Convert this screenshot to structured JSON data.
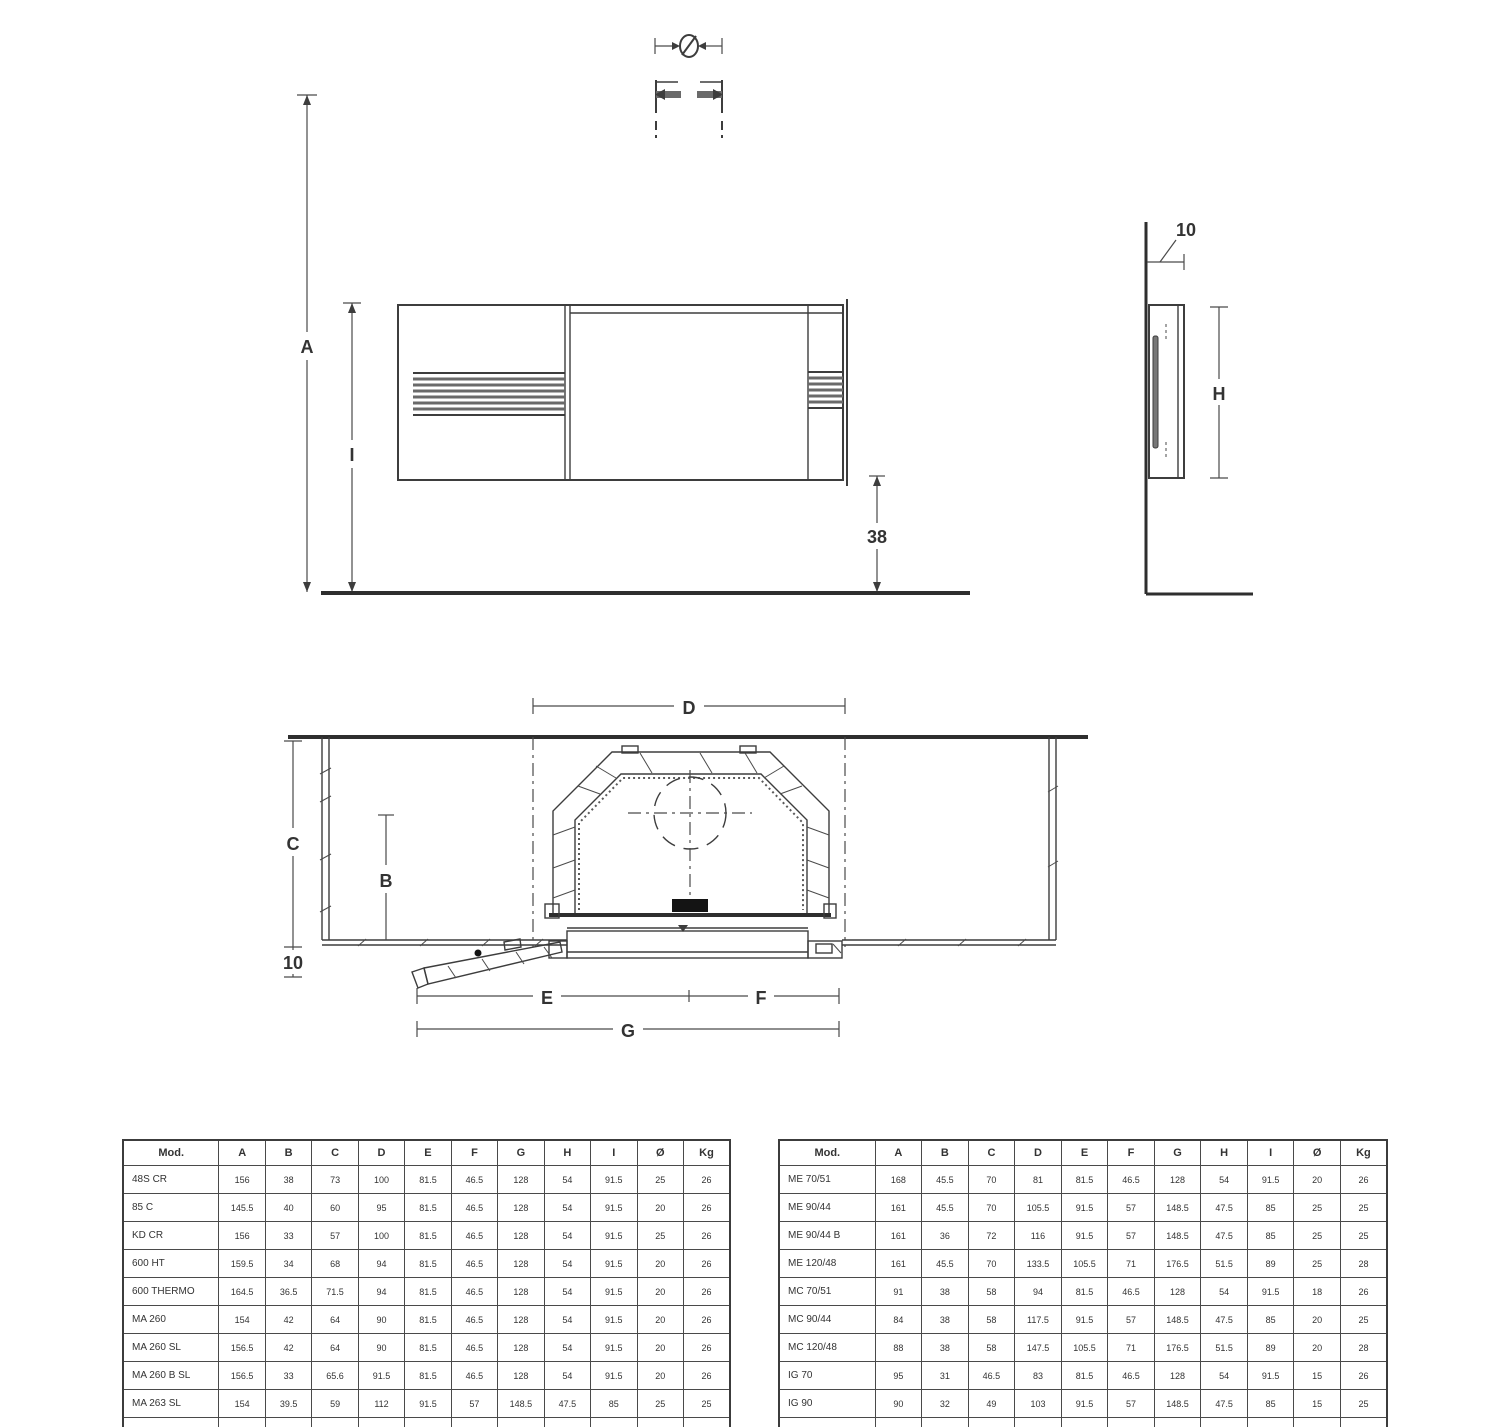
{
  "drawing": {
    "labels": {
      "flue_diameter": "Ø",
      "total_height": "A",
      "hood_top_height": "I",
      "bottom_clearance": "38",
      "wall_depth": "10",
      "glass_height": "H",
      "firebox_width": "D",
      "side_depth": "C",
      "firebox_depth": "B",
      "front_offset": "10",
      "left_width": "E",
      "right_width": "F",
      "total_width": "G"
    },
    "colors": {
      "line": "#3d3d3d",
      "grille_stripe": "#6a6a6a",
      "glass_fill": "#777777",
      "black_fill": "#141414",
      "table_border": "#4a4a4a",
      "text": "#333333"
    }
  },
  "tables": {
    "headers": [
      "Mod.",
      "A",
      "B",
      "C",
      "D",
      "E",
      "F",
      "G",
      "H",
      "I",
      "Ø",
      "Kg"
    ],
    "left": {
      "rows": [
        [
          "48S CR",
          "156",
          "38",
          "73",
          "100",
          "81.5",
          "46.5",
          "128",
          "54",
          "91.5",
          "25",
          "26"
        ],
        [
          "85 C",
          "145.5",
          "40",
          "60",
          "95",
          "81.5",
          "46.5",
          "128",
          "54",
          "91.5",
          "20",
          "26"
        ],
        [
          "KD CR",
          "156",
          "33",
          "57",
          "100",
          "81.5",
          "46.5",
          "128",
          "54",
          "91.5",
          "25",
          "26"
        ],
        [
          "600 HT",
          "159.5",
          "34",
          "68",
          "94",
          "81.5",
          "46.5",
          "128",
          "54",
          "91.5",
          "20",
          "26"
        ],
        [
          "600 THERMO",
          "164.5",
          "36.5",
          "71.5",
          "94",
          "81.5",
          "46.5",
          "128",
          "54",
          "91.5",
          "20",
          "26"
        ],
        [
          "MA 260",
          "154",
          "42",
          "64",
          "90",
          "81.5",
          "46.5",
          "128",
          "54",
          "91.5",
          "20",
          "26"
        ],
        [
          "MA 260 SL",
          "156.5",
          "42",
          "64",
          "90",
          "81.5",
          "46.5",
          "128",
          "54",
          "91.5",
          "20",
          "26"
        ],
        [
          "MA 260 B SL",
          "156.5",
          "33",
          "65.6",
          "91.5",
          "81.5",
          "46.5",
          "128",
          "54",
          "91.5",
          "20",
          "26"
        ],
        [
          "MA 263 SL",
          "154",
          "39.5",
          "59",
          "112",
          "91.5",
          "57",
          "148.5",
          "47.5",
          "85",
          "25",
          "25"
        ],
        [
          "MA 263 B SL",
          "154",
          "30",
          "60.6",
          "112",
          "91.5",
          "57",
          "148.5",
          "47.5",
          "85",
          "20",
          "25"
        ]
      ]
    },
    "right": {
      "rows": [
        [
          "ME 70/51",
          "168",
          "45.5",
          "70",
          "81",
          "81.5",
          "46.5",
          "128",
          "54",
          "91.5",
          "20",
          "26"
        ],
        [
          "ME 90/44",
          "161",
          "45.5",
          "70",
          "105.5",
          "91.5",
          "57",
          "148.5",
          "47.5",
          "85",
          "25",
          "25"
        ],
        [
          "ME 90/44 B",
          "161",
          "36",
          "72",
          "116",
          "91.5",
          "57",
          "148.5",
          "47.5",
          "85",
          "25",
          "25"
        ],
        [
          "ME 120/48",
          "161",
          "45.5",
          "70",
          "133.5",
          "105.5",
          "71",
          "176.5",
          "51.5",
          "89",
          "25",
          "28"
        ],
        [
          "MC 70/51",
          "91",
          "38",
          "58",
          "94",
          "81.5",
          "46.5",
          "128",
          "54",
          "91.5",
          "18",
          "26"
        ],
        [
          "MC 90/44",
          "84",
          "38",
          "58",
          "117.5",
          "91.5",
          "57",
          "148.5",
          "47.5",
          "85",
          "20",
          "25"
        ],
        [
          "MC 120/48",
          "88",
          "38",
          "58",
          "147.5",
          "105.5",
          "71",
          "176.5",
          "51.5",
          "89",
          "20",
          "28"
        ],
        [
          "IG 70",
          "95",
          "31",
          "46.5",
          "83",
          "81.5",
          "46.5",
          "128",
          "54",
          "91.5",
          "15",
          "26"
        ],
        [
          "IG 90",
          "90",
          "32",
          "49",
          "103",
          "91.5",
          "57",
          "148.5",
          "47.5",
          "85",
          "15",
          "25"
        ],
        [
          "IG 90 B",
          "90",
          "25",
          "50.5",
          "122",
          "91.5",
          "57",
          "148.5",
          "47.5",
          "85",
          "15",
          "25"
        ]
      ]
    }
  }
}
